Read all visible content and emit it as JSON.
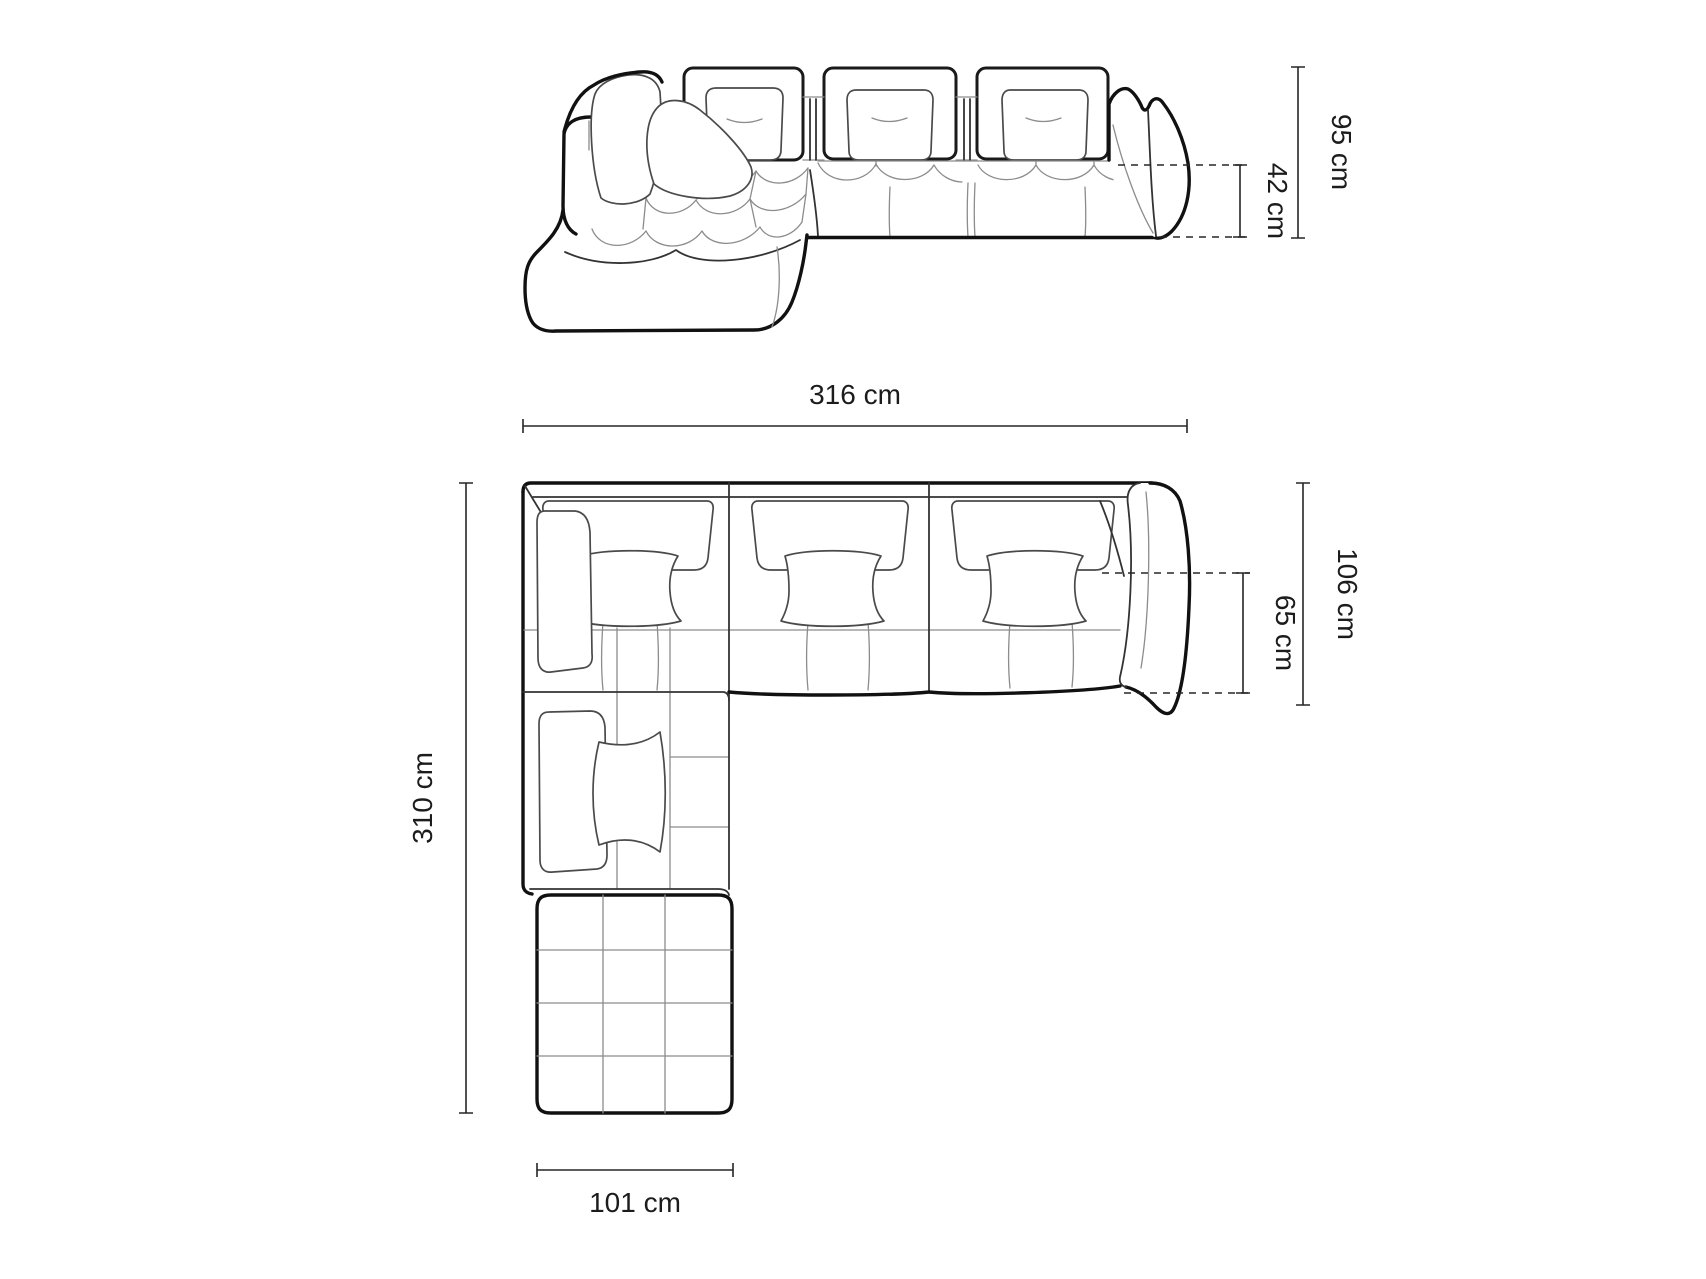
{
  "drawing": {
    "kind": "sofa-dimension-diagram",
    "views": {
      "front": "front-elevation",
      "top": "top-plan"
    }
  },
  "front_view": {
    "overall_height": "95 cm",
    "seat_height": "42 cm"
  },
  "top_view": {
    "overall_width": "316 cm",
    "overall_depth": "310 cm",
    "side_depth": "106 cm",
    "seat_depth": "65 cm",
    "chaise_width": "101 cm"
  },
  "colors": {
    "background": "#ffffff",
    "outline": "#111111",
    "mid_line": "#333333",
    "light_line": "#8c8c8c",
    "dimension": "#262626",
    "text": "#1c1c1c"
  }
}
